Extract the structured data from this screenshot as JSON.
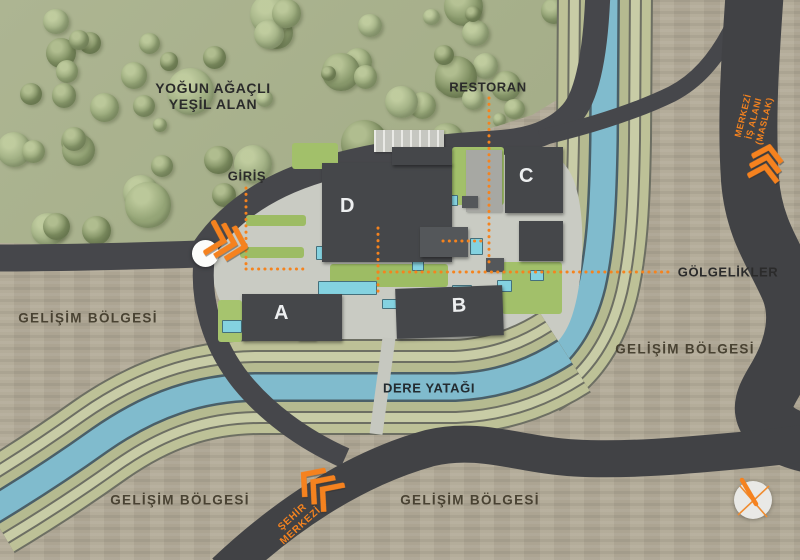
{
  "map": {
    "title": "Site plan diagram",
    "labels": {
      "forest_line1": "YOĞUN AĞAÇLI",
      "forest_line2": "YEŞİL ALAN",
      "entrance": "GİRİŞ",
      "restaurant": "RESTORAN",
      "canopies": "GÖLGELİKLER",
      "stream": "DERE YATAĞI",
      "development_zone": "GELİŞİM BÖLGESİ",
      "cbd_line1": "MERKEZİ",
      "cbd_line2": "İŞ ALANI",
      "cbd_line3": "(MASLAK)",
      "city_line1": "ŞEHİR",
      "city_line2": "MERKEZİ"
    },
    "buildings": {
      "a": {
        "label": "A"
      },
      "b": {
        "label": "B"
      },
      "c": {
        "label": "C"
      },
      "d": {
        "label": "D"
      }
    },
    "colors": {
      "accent_orange": "#f5831e",
      "road": "#46474b",
      "water": "#7fbacc",
      "lawn": "#a3c366",
      "development_beige": "#b2aa97",
      "forest_green": "#a8b18e",
      "building_gray": "#45474a",
      "terrace_olive": "#b9bd93"
    }
  }
}
